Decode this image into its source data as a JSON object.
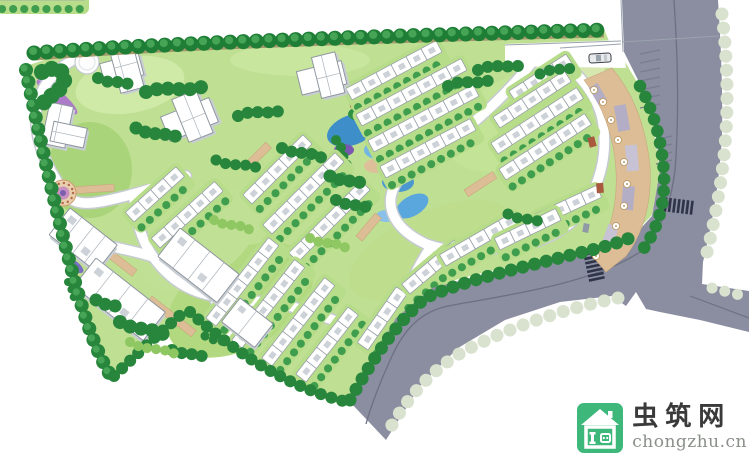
{
  "watermark": {
    "brand_name": "虫筑网",
    "brand_url": "chongzhu.cn",
    "logo_icon": "house-logo-icon",
    "logo_color": "#3eb87a",
    "brand_name_color": "#3a3a3a",
    "brand_url_color": "#8a8f8a"
  },
  "palette": {
    "background": "#ffffff",
    "lawn": "#bfdf93",
    "lawn_light": "#cfe9a6",
    "lawn_dark": "#a9d378",
    "tree_dark": "#1e7e36",
    "tree_highlight": "#45a455",
    "tree_pale": "#d9e2cf",
    "hedge_tan": "#a39a6b",
    "road_main": "#8b8da0",
    "road_line": "#6d7083",
    "road_internal": "#ffffff",
    "road_casing": "#c6cbd1",
    "building": "#ffffff",
    "building_stroke": "#8f979f",
    "building_shadow": "#c9ced4",
    "paving_tan": "#dcbd96",
    "paving_purple": "#b3aec6",
    "water_blue": "#4a98cf",
    "accent_red": "#b5523c",
    "flower_purple": "#ad7cc8",
    "crosswalk_stripe": "#2f3448"
  },
  "scene": {
    "kind": "residential-community-landscape-master-plan"
  }
}
